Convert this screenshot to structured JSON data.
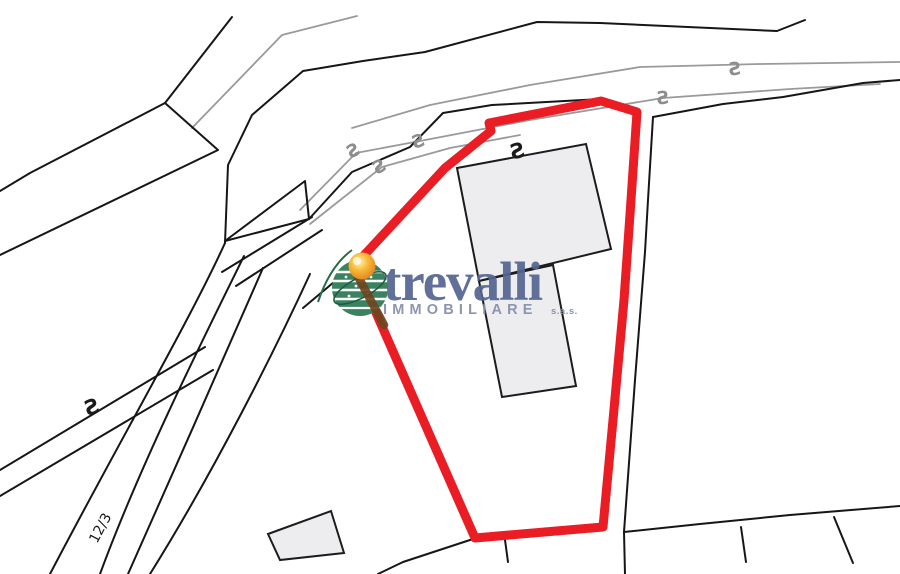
{
  "window": {
    "width": 900,
    "height": 574,
    "background": "#ffffff"
  },
  "map": {
    "kind": "cadastral parcel plan with highlighted lot",
    "parcel_label": "12/3",
    "marker_symbol": "S",
    "marker_count_black": 2,
    "marker_count_gray": 5,
    "building_count": 3,
    "colors": {
      "boundary_line": "#161616",
      "secondary_line": "#9a9a9a",
      "highlight_outline": "#e91d23",
      "building_fill": "#ededef"
    }
  },
  "watermark": {
    "brand": "trevalli",
    "subtitle": "IMMOBILIARE",
    "legal_suffix": "s.a.s.",
    "brand_color": "#566692",
    "subtitle_color": "#8791ad",
    "globe_green": "#3a8260",
    "sun_orange": "#f7b733",
    "line_through_logo": "#6f451f"
  }
}
